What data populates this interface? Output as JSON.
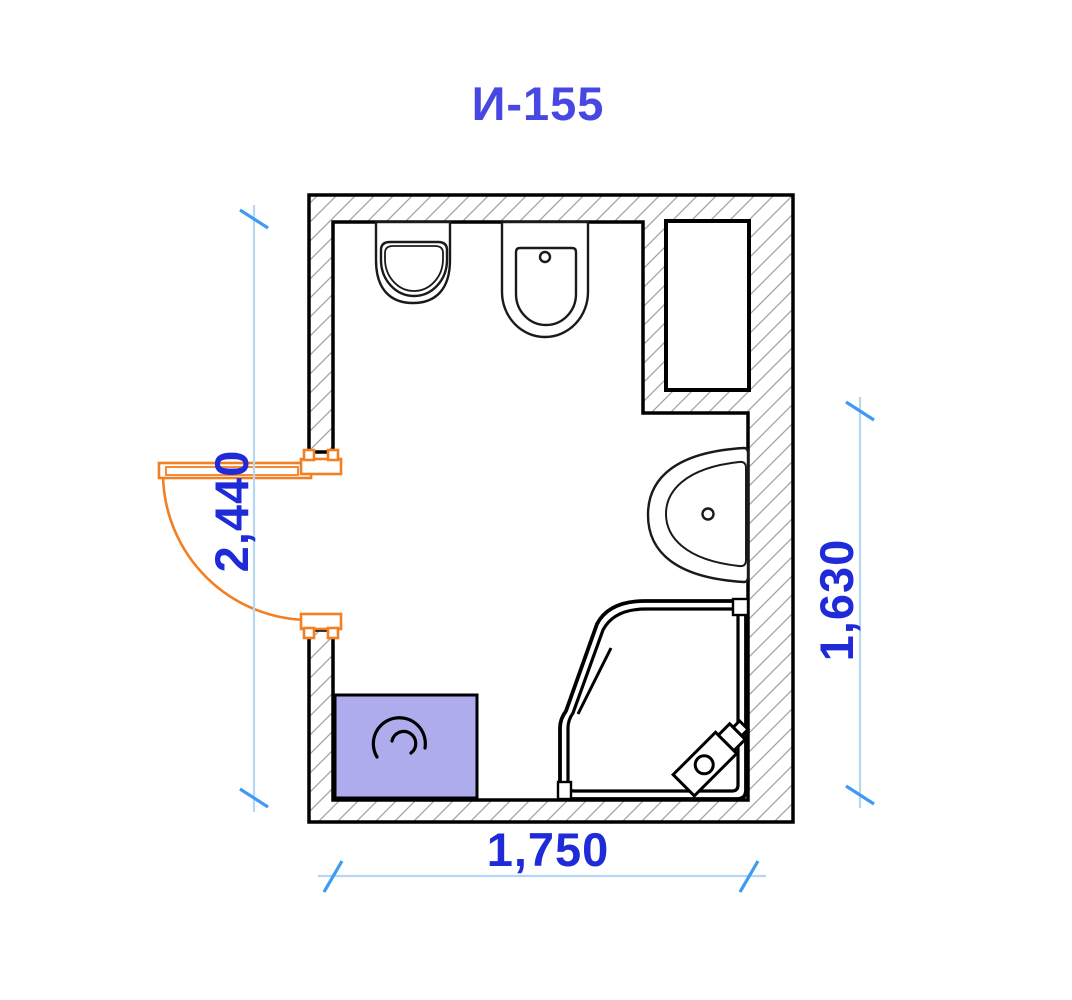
{
  "title": "И-155",
  "dimensions": {
    "left_vertical": "2,440",
    "right_vertical": "1,630",
    "bottom_horizontal": "1,750"
  },
  "colors": {
    "title_text": "#4747e2",
    "dimension_text": "#1f2bd8",
    "dimension_line": "#b5d7f3",
    "dimension_tick": "#3e9af2",
    "door": "#f28022",
    "washing_machine": "#aeacec",
    "wall_hatch": "#a3a3a3",
    "line": "#000000"
  },
  "fixtures": {
    "urinal": "urinal",
    "toilet": "toilet",
    "shaft": "ventilation-shaft",
    "sink": "sink",
    "shower": "corner-shower",
    "washing_machine": "washing-machine",
    "door": "door"
  }
}
